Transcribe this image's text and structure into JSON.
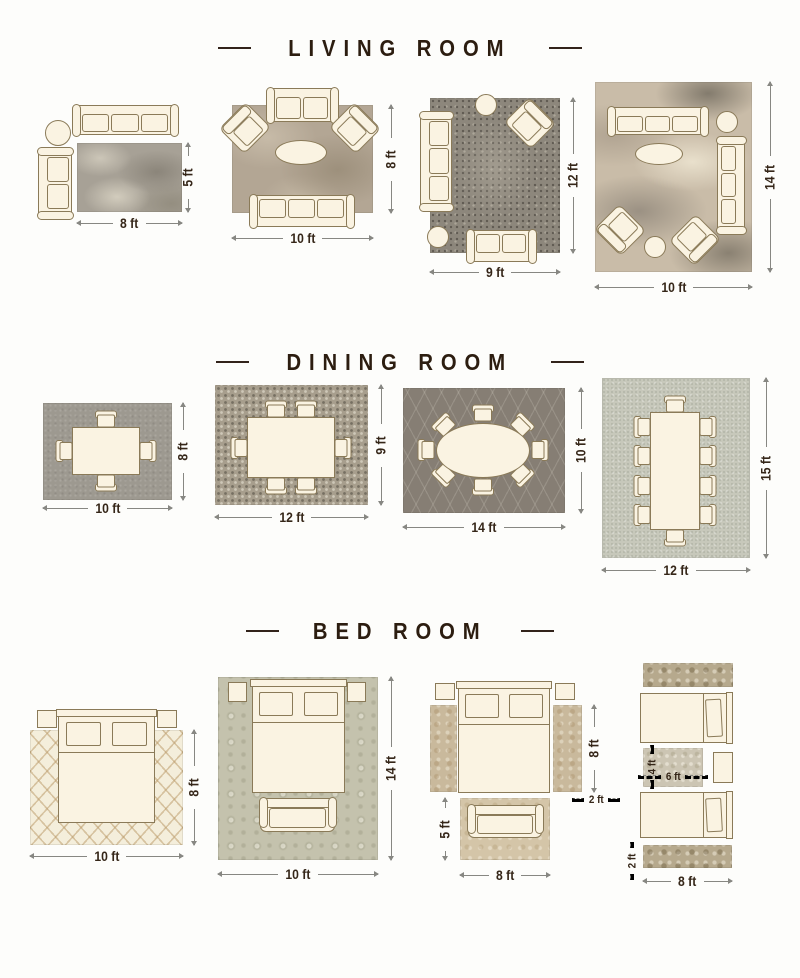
{
  "page": {
    "background": "#fdfdfb",
    "title_color": "#2c1d10",
    "dimension_text_color": "#352618",
    "dimension_line_color": "#878782",
    "furniture_fill": "#faf3e2",
    "furniture_outline": "#8a7a58"
  },
  "sections": {
    "living": {
      "title": "LIVING ROOM",
      "layouts": [
        {
          "width_label": "8 ft",
          "height_label": "5 ft"
        },
        {
          "width_label": "10 ft",
          "height_label": "8 ft"
        },
        {
          "width_label": "9 ft",
          "height_label": "12 ft"
        },
        {
          "width_label": "10 ft",
          "height_label": "14 ft"
        }
      ]
    },
    "dining": {
      "title": "DINING ROOM",
      "layouts": [
        {
          "width_label": "10 ft",
          "height_label": "8 ft"
        },
        {
          "width_label": "12 ft",
          "height_label": "9 ft"
        },
        {
          "width_label": "14 ft",
          "height_label": "10 ft"
        },
        {
          "width_label": "12 ft",
          "height_label": "15 ft"
        }
      ]
    },
    "bedroom": {
      "title": "BED ROOM",
      "layouts": [
        {
          "width_label": "10 ft",
          "height_label": "8 ft"
        },
        {
          "width_label": "10 ft",
          "height_label": "14 ft"
        },
        {
          "bed_area_height_label": "8 ft",
          "runner_width_label": "2 ft",
          "bottom_rug_width_label": "8 ft",
          "bottom_rug_height_label": "5 ft"
        },
        {
          "middle_rug_height_label": "4 ft",
          "middle_rug_width_label": "6 ft",
          "runner_height_label": "2 ft",
          "runner_width_label": "8 ft"
        }
      ]
    }
  }
}
